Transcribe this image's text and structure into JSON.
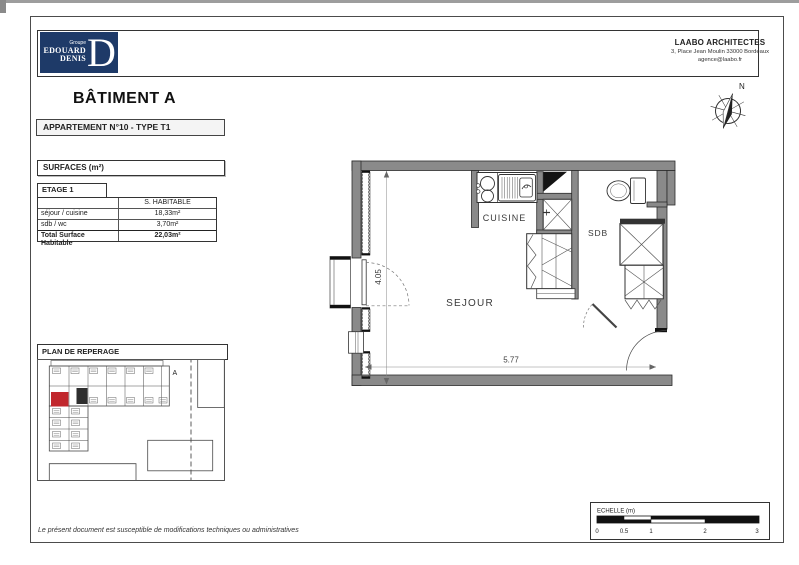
{
  "branding": {
    "group": "Groupe",
    "name_line1": "EDOUARD",
    "name_line2": "DENIS",
    "monogram": "D"
  },
  "architect": {
    "name": "LAABO ARCHITECTES",
    "address": "3, Place Jean Moulin  33000 Bordeaux",
    "email": "agence@laabo.fr"
  },
  "titles": {
    "building": "BÂTIMENT A",
    "apartment": "APPARTEMENT N°10 - TYPE T1"
  },
  "surfaces": {
    "box_title": "SURFACES (m²)",
    "floor": "ETAGE 1",
    "column_header": "S. HABITABLE",
    "rows": [
      {
        "label": "séjour / cuisine",
        "value": "18,33m²"
      },
      {
        "label": "sdb / wc",
        "value": "3,70m²"
      }
    ],
    "total_label": "Total Surface Habitable",
    "total_value": "22,03m²"
  },
  "floor_plan": {
    "room_sejour": "SEJOUR",
    "room_cuisine": "CUISINE",
    "room_sdb": "SDB",
    "dim_width": "5.77",
    "dim_height": "4.05"
  },
  "reperage": {
    "title": "PLAN DE REPERAGE",
    "building_label": "A"
  },
  "compass": {
    "north": "N"
  },
  "scale_bar": {
    "title": "ECHELLE (m)",
    "ticks": [
      "0",
      "0.5",
      "1",
      "2",
      "3"
    ]
  },
  "footer": {
    "note": "Le présent document est susceptible de modifications techniques ou administratives"
  },
  "colors": {
    "brand_navy": "#1e3a68",
    "wall_gray": "#8a8a8a",
    "highlight_red": "#c1272d"
  }
}
